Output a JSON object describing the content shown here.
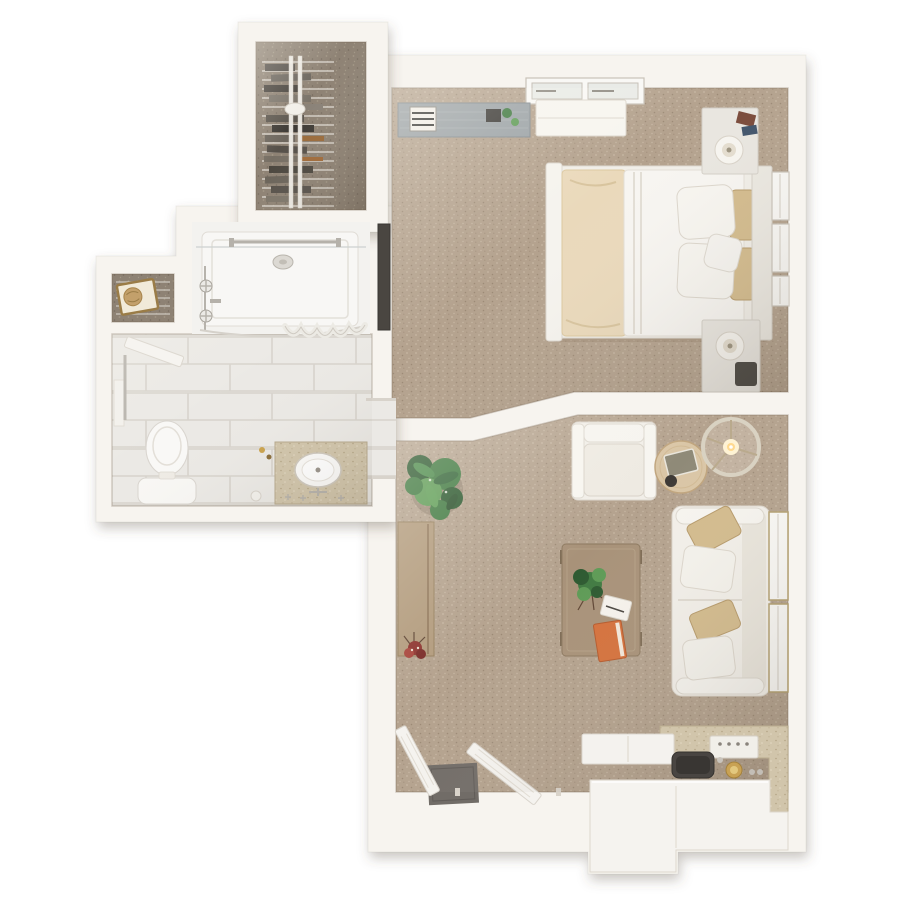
{
  "scene": {
    "label": "3D top-down floor plan of a one-bedroom apartment with bedroom, living room, kitchenette, bathroom and walk-in closet",
    "width": 900,
    "height": 900
  },
  "palette": {
    "bg": "#ffffff",
    "wall": "#f7f4ef",
    "wall-edge": "rgba(112,94,74,0.28)",
    "carpet": "#b4a28e",
    "carpet-dot-a": "#c7b7a3",
    "carpet-dot-b": "#9c8a76",
    "carpet-dark": "#8e8274",
    "carpet-dark-dot-a": "#a29786",
    "carpet-dark-dot-b": "#776c5f",
    "tile": "#ebe9e5",
    "grout": "#d7d3cc",
    "shower": "#f8f7f5",
    "granite": "#d1c5ab",
    "granite-dot-a": "#e3d9c3",
    "granite-dot-b": "#b4a586",
    "wood": "#a89279",
    "wood-light": "#dac6a6",
    "wood-edge": "#8c7860",
    "wood-gray": "#9ba2a6",
    "wood-gray-edge": "#838b90",
    "fabric": "#f2efe9",
    "fabric-edge": "#dcd6cc",
    "fabric-shade": "#e8e3da",
    "pillow-tan": "#d3bb8d",
    "pillow-tan-edge": "#b69a6b",
    "throw": "#ead9bb",
    "throw-line": "#d8c49e",
    "plant-dark": "#2e5a31",
    "plant-mid": "#417a42",
    "plant-light": "#5e9b56",
    "chrome": "#b7b3ac",
    "glass": "#e9ebe7",
    "trim": "#b3a071",
    "sink-dark": "#494542",
    "sink-dark-deep": "#393633",
    "mat": "#716c67",
    "basket": "#c3a06b",
    "basket-edge": "#9a7c47",
    "flower": "#8e3530",
    "book-orange": "#d5713c",
    "lamp-glow": "#ffd98e",
    "panel-dark": "#4a4641"
  },
  "rooms": [
    {
      "id": "walk-in-closet",
      "furniture": [
        "wire-shelving-rack",
        "clothes-stacks",
        "dark-carpet"
      ]
    },
    {
      "id": "bathroom",
      "furniture": [
        "walk-in-shower",
        "towel-bar",
        "shower-curtain",
        "faucet-handles",
        "linen-niche",
        "storage-basket",
        "swing-door",
        "toilet",
        "grab-bar",
        "vanity-counter",
        "round-sink"
      ]
    },
    {
      "id": "bedroom",
      "furniture": [
        "double-window",
        "media-console",
        "white-credenza",
        "double-bed",
        "cream-throw",
        "pillows",
        "headboard",
        "nightstand-top",
        "nightstand-bottom",
        "table-lamps",
        "dark-wall-panel",
        "side-windows"
      ]
    },
    {
      "id": "living-room",
      "furniture": [
        "armchair",
        "round-side-table",
        "floor-lamp",
        "sofa",
        "throw-pillows",
        "coffee-table",
        "potted-plant",
        "console-desk",
        "flower-vase",
        "entry-doors",
        "door-mat",
        "side-windows"
      ]
    },
    {
      "id": "kitchenette",
      "furniture": [
        "granite-counter",
        "white-cabinets",
        "dark-sink",
        "cooktop",
        "faucet"
      ]
    }
  ]
}
